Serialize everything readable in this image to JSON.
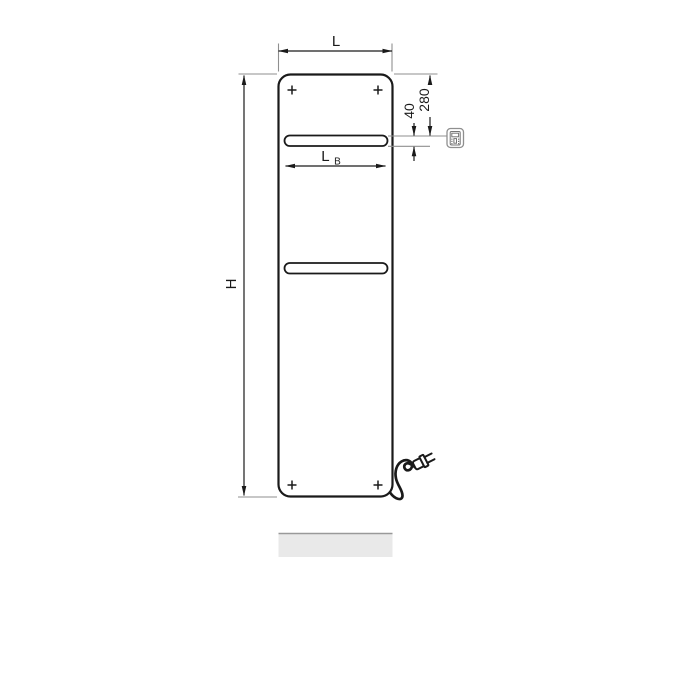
{
  "drawing": {
    "dim_width": {
      "label": "L"
    },
    "dim_height": {
      "label": "H"
    },
    "dim_top_offset": {
      "label": "280"
    },
    "dim_rail_thickness": {
      "label": "40"
    },
    "dim_rail_width": {
      "label": "L",
      "subscript": "B"
    },
    "icons": {
      "control_unit": "control-unit-icon",
      "power_plug": "power-plug-icon"
    },
    "colors": {
      "background": "#ffffff",
      "panel_fill": "#d3d3d3",
      "panel_stroke": "#1a1a1a",
      "rail_fill": "#e0e0e0",
      "dimension_line": "#1a1a1a",
      "extension_line": "#8f8f8f",
      "shadow_fill": "#e9e9e9",
      "shadow_edge": "#999999",
      "icon_stroke": "#8f8f8f"
    }
  }
}
